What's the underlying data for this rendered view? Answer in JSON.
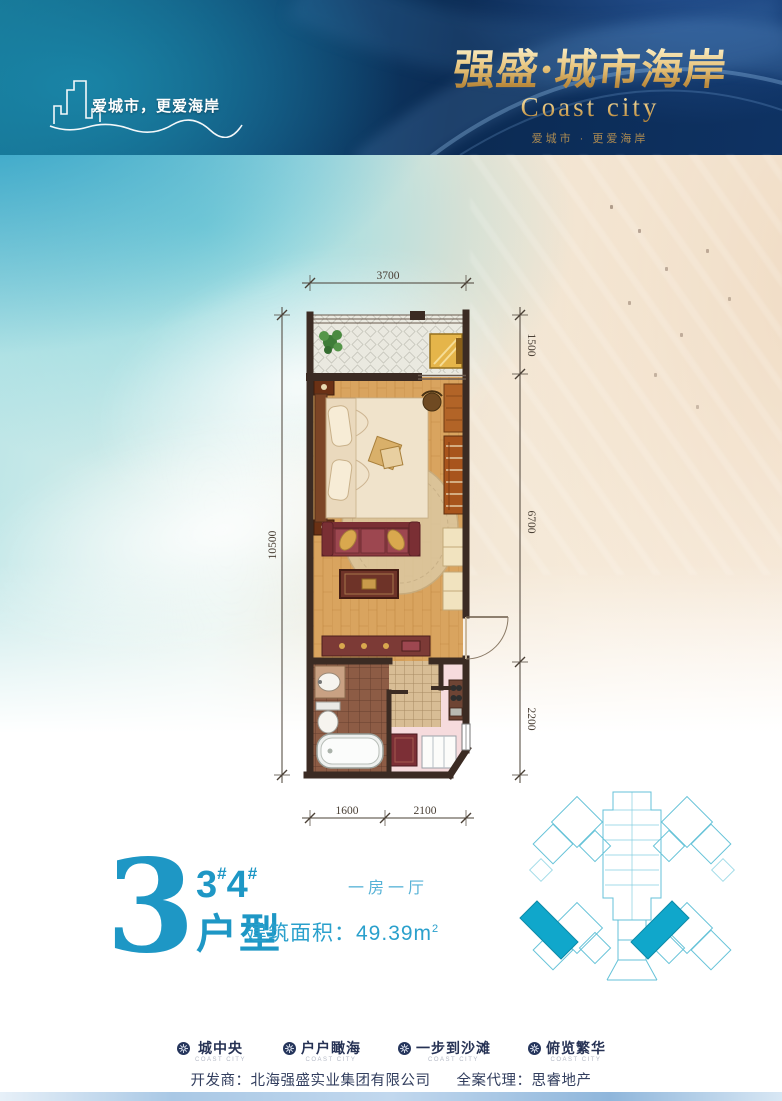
{
  "banner": {
    "tagline": "爱城市，更爱海岸",
    "brand_cn": "强盛·城市海岸",
    "brand_en": "Coast city",
    "brand_sub": "爱城市 · 更爱海岸"
  },
  "floor_plan": {
    "dim_top": "3700",
    "dim_left": "10500",
    "dim_right_1": "1500",
    "dim_right_2": "6700",
    "dim_right_3": "2200",
    "dim_bottom_1": "1600",
    "dim_bottom_2": "2100"
  },
  "unit_info": {
    "big_number": "3",
    "building_a": "3",
    "building_a_mark": "#",
    "building_b": "4",
    "building_b_mark": "#",
    "type_label": "户型",
    "layout": "一房一厅",
    "area": "建筑面积：49.39m",
    "area_sup": "2"
  },
  "features": {
    "items": [
      {
        "label": "城中央",
        "caption": "COAST CITY"
      },
      {
        "label": "户户瞰海",
        "caption": "COAST CITY"
      },
      {
        "label": "一步到沙滩",
        "caption": "COAST CITY"
      },
      {
        "label": "俯览繁华",
        "caption": "COAST CITY"
      }
    ]
  },
  "footer": {
    "developer": "开发商：北海强盛实业集团有限公司",
    "agent": "全案代理：思睿地产"
  },
  "colors": {
    "accent_cyan": "#1e97c5",
    "banner_navy": "#0b2a52",
    "banner_teal": "#15718f",
    "gold": "#e7c47c",
    "site_teal": "#10a7cb",
    "wall": "#3b2b23"
  }
}
